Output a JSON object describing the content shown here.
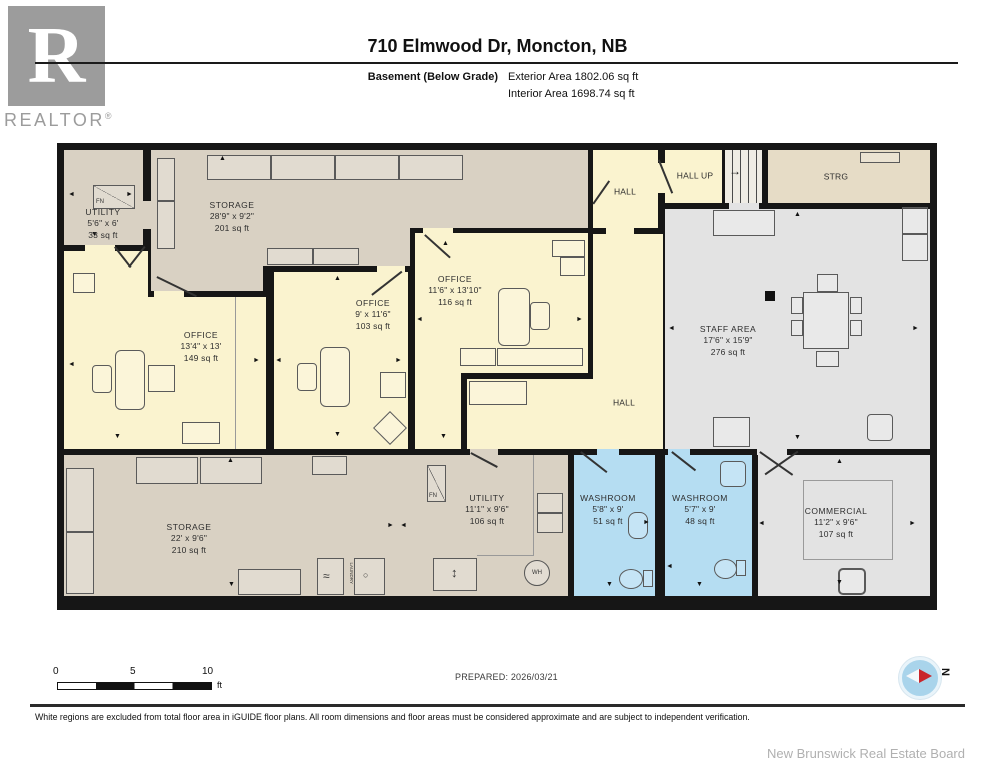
{
  "logo": {
    "letter": "R",
    "brand": "REALTOR",
    "registered": "®"
  },
  "header": {
    "title": "710 Elmwood Dr, Moncton, NB",
    "floor_label": "Basement (Below Grade)",
    "exterior_area": "Exterior Area 1802.06 sq ft",
    "interior_area": "Interior Area 1698.74 sq ft"
  },
  "rooms": [
    {
      "id": "utility-top",
      "name": "UTILITY",
      "dims": "5'6\" x 6'",
      "area": "33 sq ft"
    },
    {
      "id": "storage-top",
      "name": "STORAGE",
      "dims": "28'9\" x 9'2\"",
      "area": "201 sq ft"
    },
    {
      "id": "office-1",
      "name": "OFFICE",
      "dims": "13'4\" x 13'",
      "area": "149 sq ft"
    },
    {
      "id": "office-2",
      "name": "OFFICE",
      "dims": "9' x 11'6\"",
      "area": "103 sq ft"
    },
    {
      "id": "office-3",
      "name": "OFFICE",
      "dims": "11'6\" x 13'10\"",
      "area": "116 sq ft"
    },
    {
      "id": "staff-area",
      "name": "STAFF AREA",
      "dims": "17'6\" x 15'9\"",
      "area": "276 sq ft"
    },
    {
      "id": "storage-bottom",
      "name": "STORAGE",
      "dims": "22' x 9'6\"",
      "area": "210 sq ft"
    },
    {
      "id": "utility-bottom",
      "name": "UTILITY",
      "dims": "11'1\" x 9'6\"",
      "area": "106 sq ft"
    },
    {
      "id": "washroom-1",
      "name": "WASHROOM",
      "dims": "5'8\" x 9'",
      "area": "51 sq ft"
    },
    {
      "id": "washroom-2",
      "name": "WASHROOM",
      "dims": "5'7\" x 9'",
      "area": "48 sq ft"
    },
    {
      "id": "commercial",
      "name": "COMMERCIAL",
      "dims": "11'2\" x 9'6\"",
      "area": "107 sq ft"
    }
  ],
  "halls": {
    "hall_top": "HALL",
    "hall_up": "HALL UP",
    "strg": "STRG",
    "hall_mid": "HALL"
  },
  "symbols": {
    "furnace": "FN",
    "water_heater": "WH",
    "laundry": "LAUNDRY"
  },
  "icons": {
    "arrow_up": "▲",
    "arrow_down": "▼",
    "arrow_left": "◄",
    "arrow_right": "►",
    "stairs_arrow": "→",
    "updown_arrow": "↕",
    "wave": "≈",
    "drop": "○",
    "compass_north": "N"
  },
  "scale_bar": {
    "tick_0": "0",
    "tick_5": "5",
    "tick_10": "10",
    "unit": "ft"
  },
  "footer": {
    "prepared": "PREPARED: 2026/03/21",
    "disclaimer": "White regions are excluded from total floor area in iGUIDE floor plans. All room dimensions and floor areas must be considered approximate and are subject to independent verification.",
    "attribution": "New Brunswick Real Estate Board"
  },
  "colors": {
    "wall": "#161616",
    "office_yellow": "#faf3cf",
    "storage_tan": "#d9d1c3",
    "strg_tan": "#e6dcc6",
    "area_gray": "#e3e3e3",
    "washroom_blue": "#b5ddf2",
    "compass_blue": "#a9d4eb",
    "compass_red": "#c9252b",
    "logo_gray": "#9c9c9c"
  }
}
